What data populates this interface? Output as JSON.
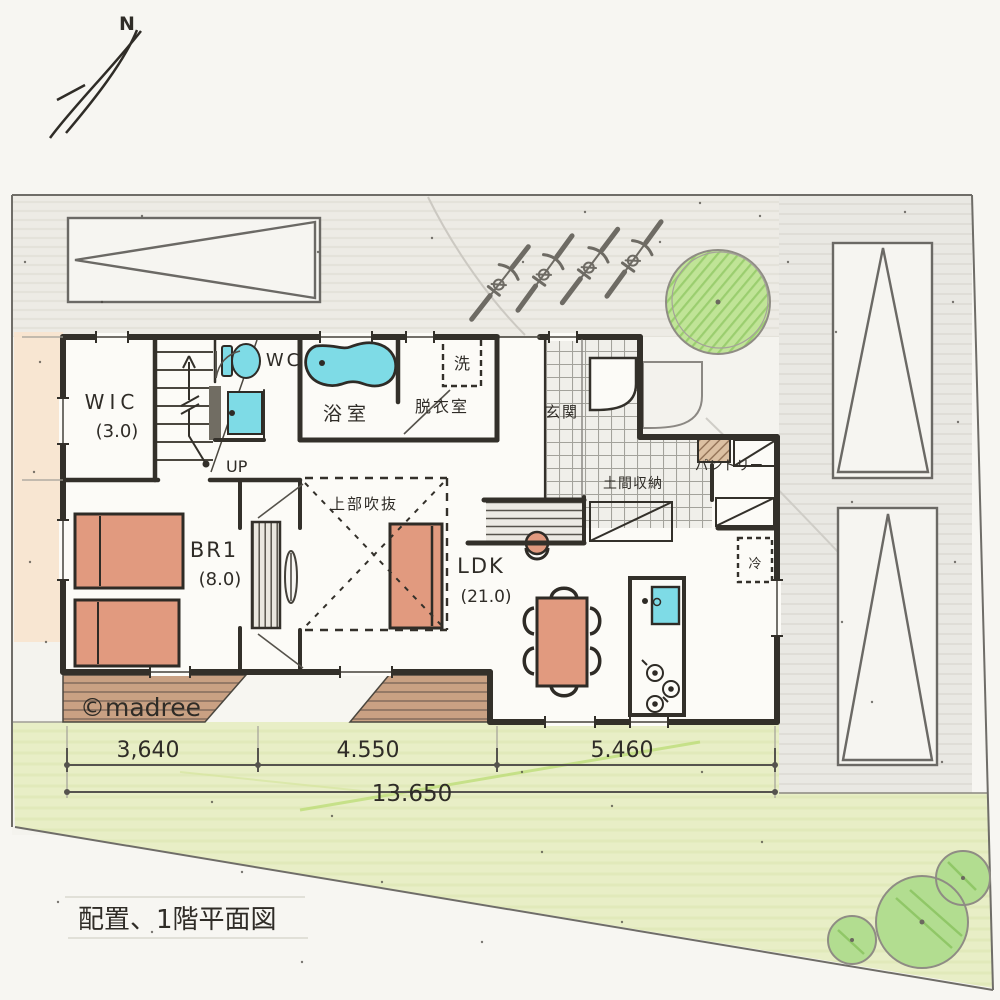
{
  "plan": {
    "north_label": "N",
    "title": "配置、1階平面図",
    "watermark": "©madree",
    "rooms": {
      "wic": {
        "label": "WIC",
        "area": "(3.0)"
      },
      "wc": {
        "label": "WC"
      },
      "bath": {
        "label": "浴室"
      },
      "dressing": {
        "label": "脱衣室"
      },
      "washer": {
        "label": "洗"
      },
      "entrance": {
        "label": "玄関"
      },
      "doma_storage": {
        "label": "土間収納"
      },
      "pantry": {
        "label": "パントリー"
      },
      "void_above": {
        "label": "上部吹抜"
      },
      "stairs": {
        "label": "UP"
      },
      "br1": {
        "label": "BR1",
        "area": "(8.0)"
      },
      "ldk": {
        "label": "LDK",
        "area": "(21.0)"
      },
      "fridge": {
        "label": "冷"
      }
    },
    "dimensions": {
      "seg1": "3,640",
      "seg2": "4.550",
      "seg3": "5.460",
      "total": "13.650"
    },
    "colors": {
      "ink": "#33302a",
      "water": "#7edbe6",
      "furniture": "#e19a7f",
      "lawn": "#e8eec6",
      "tree": "#c0e497",
      "deck": "#c9a183",
      "concrete": "#e9e8e3",
      "paper": "#f7f6f2",
      "tile": "#f0efea"
    }
  }
}
